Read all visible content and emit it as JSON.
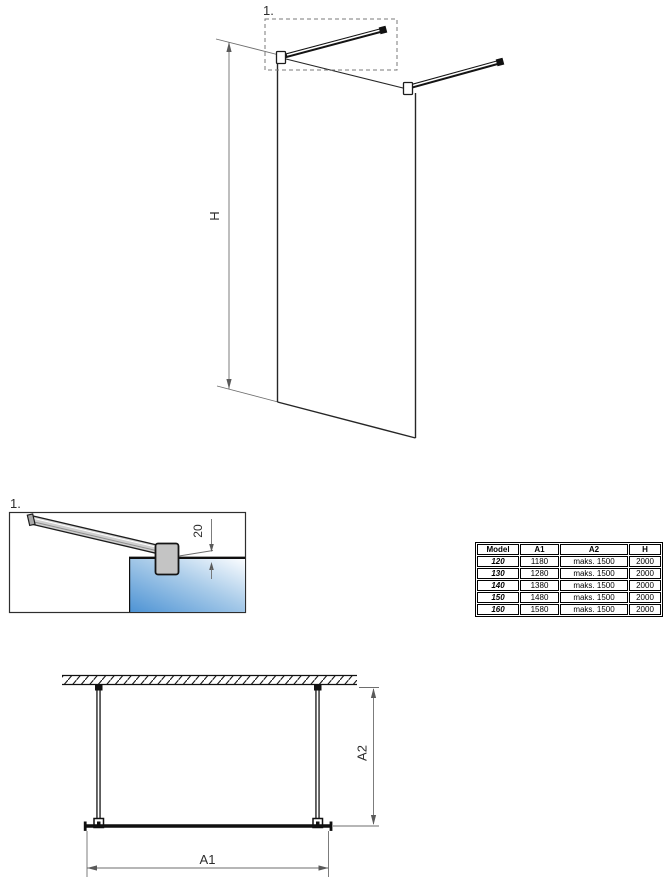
{
  "drawing": {
    "labels": {
      "detail_marker": "1.",
      "height": "H",
      "bar_offset": "20",
      "width": "A1",
      "depth": "A2"
    },
    "colors": {
      "line": "#262626",
      "dim_line": "#6e6e6e",
      "glass_dark": "#4d93d4",
      "glass_mid": "#a8cbe9",
      "glass_light": "#fbfdff",
      "metal_gray": "#c9c9c9"
    }
  },
  "size_table": {
    "headers": [
      "Model",
      "A1",
      "A2",
      "H"
    ],
    "rows": [
      {
        "model": "120",
        "a1": "1180",
        "a2": "maks. 1500",
        "h": "2000"
      },
      {
        "model": "130",
        "a1": "1280",
        "a2": "maks. 1500",
        "h": "2000"
      },
      {
        "model": "140",
        "a1": "1380",
        "a2": "maks. 1500",
        "h": "2000"
      },
      {
        "model": "150",
        "a1": "1480",
        "a2": "maks. 1500",
        "h": "2000"
      },
      {
        "model": "160",
        "a1": "1580",
        "a2": "maks. 1500",
        "h": "2000"
      }
    ]
  }
}
